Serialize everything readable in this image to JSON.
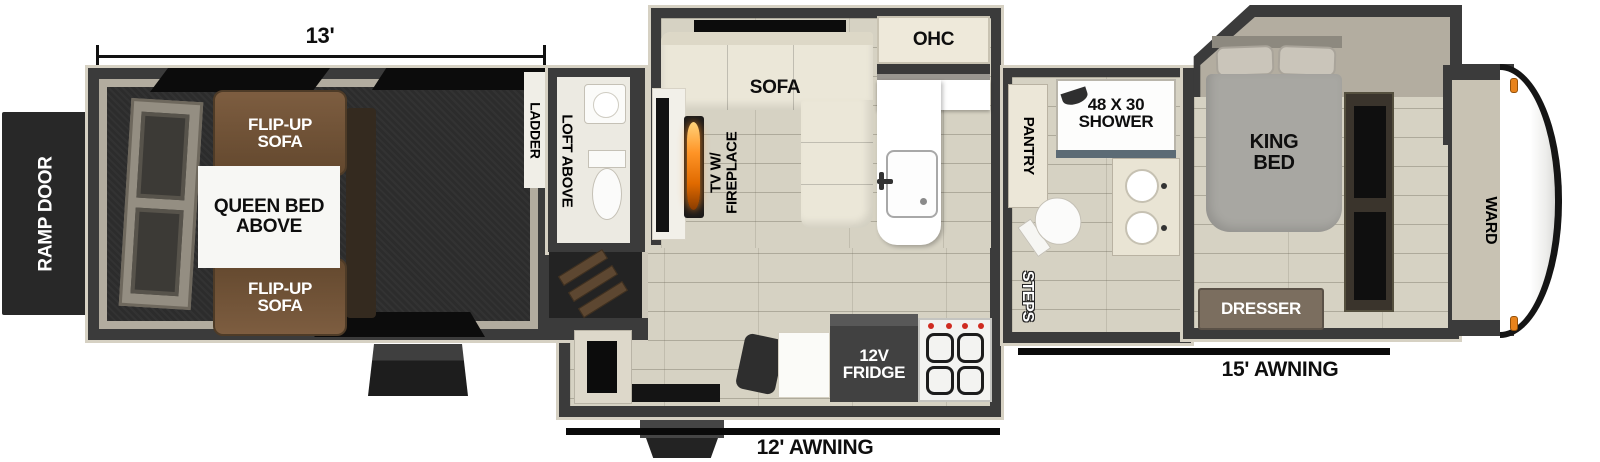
{
  "colors": {
    "wall": "#3b3b3b",
    "trim": "#d6d1c3",
    "floor": "#d6d2c3",
    "garage_floor": "#2c2c2c",
    "sofa_brown": "#6b4e36",
    "cream_furniture": "#ece7d8",
    "flame_orange": "#ff8c1f",
    "marker_light": "#e8831c",
    "awning_line": "#0a0a0a"
  },
  "exterior": {
    "ramp_door": "RAMP DOOR",
    "garage_dimension": "13'",
    "awning_12": "12' AWNING",
    "awning_15": "15' AWNING"
  },
  "garage": {
    "flip_up_sofa_top": "FLIP-UP\nSOFA",
    "flip_up_sofa_bottom": "FLIP-UP\nSOFA",
    "queen_bed_above": "QUEEN BED\nABOVE",
    "ladder": "LADDER"
  },
  "living": {
    "loft_above": "LOFT ABOVE",
    "tv_fireplace": "TV W/\nFIREPLACE",
    "sofa": "SOFA",
    "ohc": "OHC",
    "fridge": "12V\nFRIDGE"
  },
  "bathroom": {
    "pantry": "PANTRY",
    "shower": "48 X 30\nSHOWER",
    "steps": "STEPS"
  },
  "bedroom": {
    "king_bed": "KING\nBED",
    "ward": "WARD",
    "dresser": "DRESSER"
  }
}
